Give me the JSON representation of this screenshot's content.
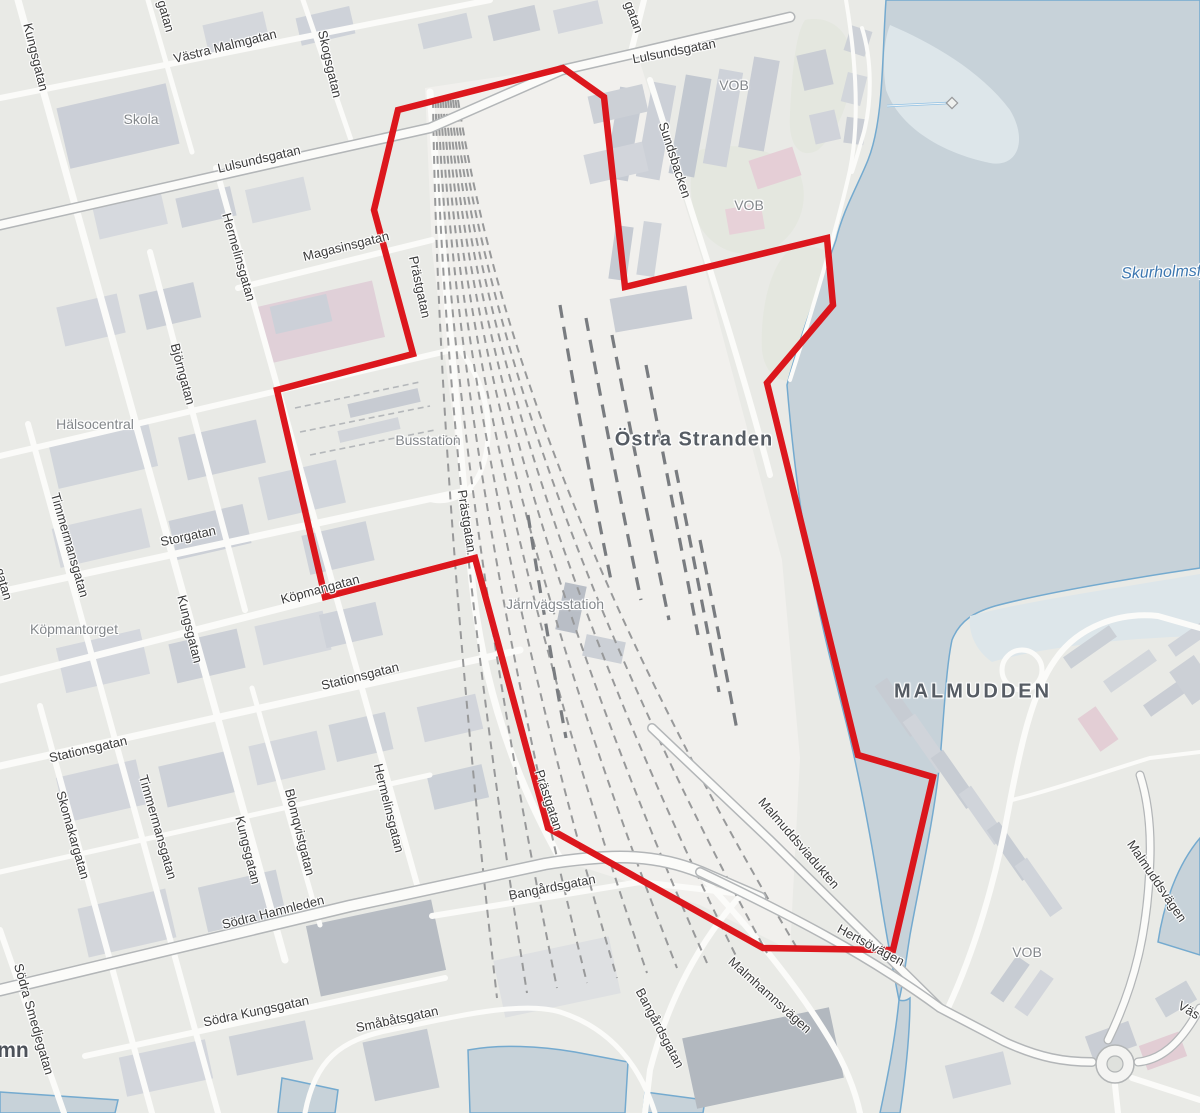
{
  "map_title": "Luleå detail map with project area boundary",
  "boundary": {
    "stroke_color": "#db1016",
    "points": "563,68 604,97 625,287 827,238 833,305 767,383 858,755 933,777 893,950 763,948 548,828 475,558 325,597 277,390 413,354 374,210 398,110"
  },
  "labels": {
    "streets": {
      "kungsgatan_nw": "Kungsgatan",
      "vastra_malmgatan": "Västra Malmgatan",
      "skogsgatan": "Skogsgatan",
      "lulsundsgatan_w": "Lulsundsgatan",
      "lulsundsgatan_n": "Lulsundsgatan",
      "hermelinsgatan_n": "Hermelinsgatan",
      "magasinsgatan": "Magasinsgatan",
      "prastgatan_n": "Prästgatan",
      "sundsbacken": "Sundsbacken",
      "bjorngatan": "Björngatan",
      "prastgatan_mid": "Prästgatan",
      "timmermansgatan_n": "Timmermansgatan",
      "storgatan": "Storgatan",
      "kopmangatan": "Köpmangatan",
      "kungsgatan_mid": "Kungsgatan",
      "stationsgatan_e": "Stationsgatan",
      "stationsgatan_w": "Stationsgatan",
      "skomakargatan": "Skomakargatan",
      "timmermansgatan_s": "Timmermansgatan",
      "kungsgatan_s": "Kungsgatan",
      "blomqvistgatan": "Blomqvistgatan",
      "hermelinsgatan_s": "Hermelinsgatan",
      "prastgatan_s": "Prästgatan",
      "sodra_hamnleden": "Södra Hamnleden",
      "bangardsgatan_n": "Bangårdsgatan",
      "malmuddsviadukten": "Malmuddsviadukten",
      "hertsovagen": "Hertsövägen",
      "malmhamnsvagen": "Malmhamnsvägen",
      "bangardsgatan_s": "Bangårdsgatan",
      "sodra_smedjegatan": "Södra Smedjegatan",
      "sodra_kungsgatan": "Södra Kungsgatan",
      "smabatsgatan": "Småbåtsgatan",
      "malmuddsvagen": "Malmuddsvägen"
    },
    "places": {
      "skola": "Skola",
      "halsocentral": "Hälsocentral",
      "kopmantorget": "Köpmantorget",
      "busstation": "Busstation",
      "jarnvagsstation": "Järnvägsstation",
      "vob_north": "VOB",
      "vob_mid": "VOB",
      "vob_south": "VOB"
    },
    "areas": {
      "ostra_stranden": "Östra Stranden",
      "malmudden": "MALMUDDEN"
    },
    "water": {
      "skurholmsfjarden_partial": "Skurholmsfj"
    },
    "partials": {
      "gatan_nw": "gatan",
      "gatan_n": "gatan",
      "gatan_w": "gatan",
      "hamn": "mn",
      "vas": "Väs"
    }
  }
}
